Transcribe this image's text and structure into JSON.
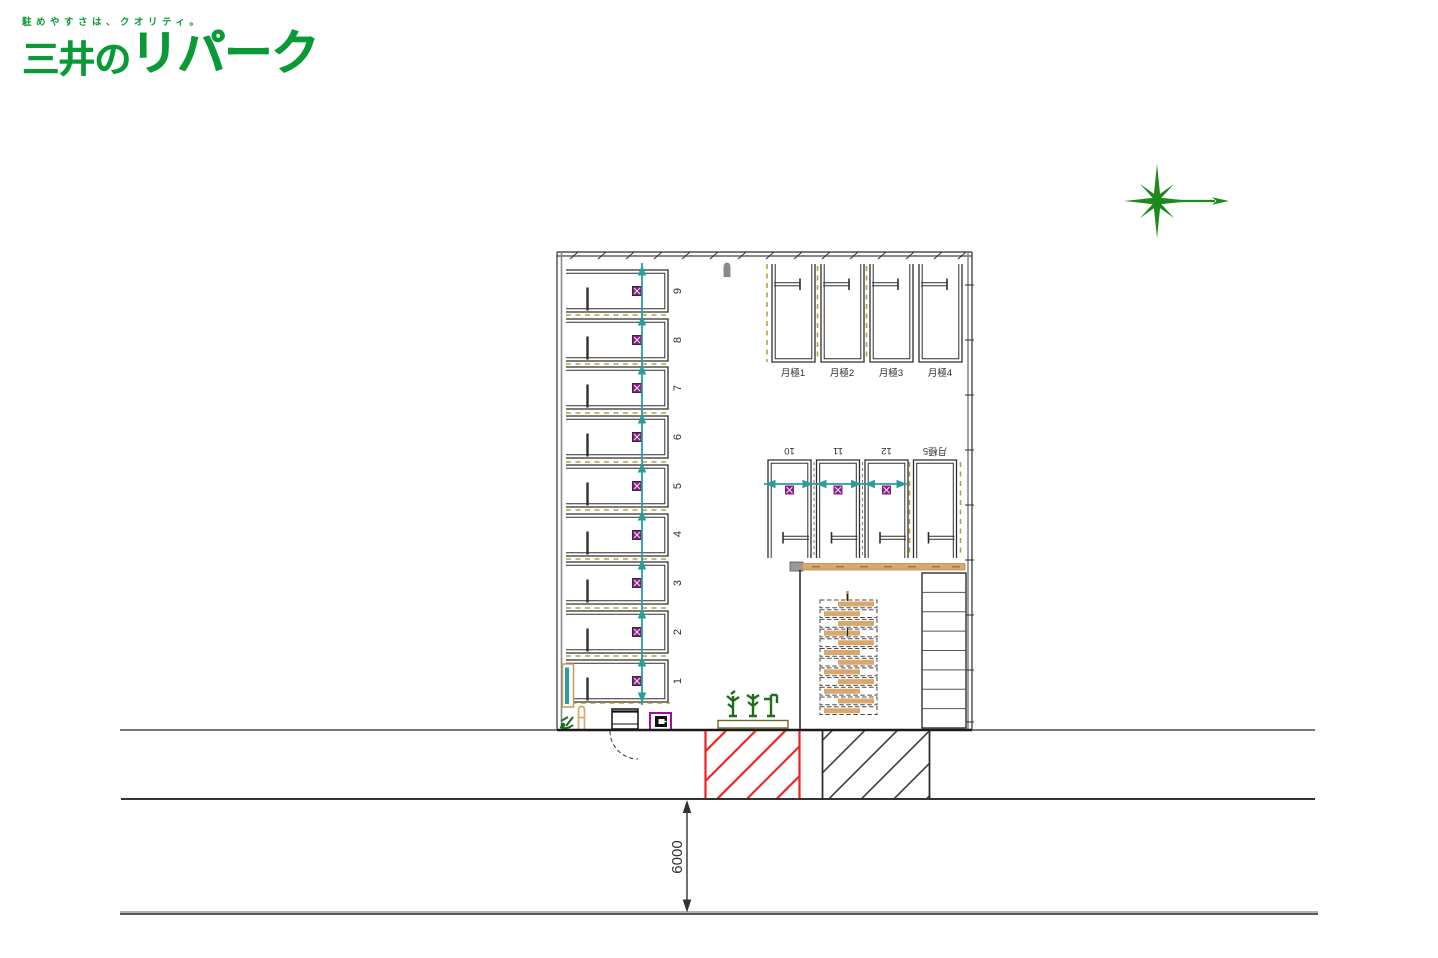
{
  "logo": {
    "tagline": "駐めやすさは、クオリティ。",
    "brand_prefix": "三井の",
    "brand_main": "リパーク",
    "brand_color": "#0a9a35"
  },
  "compass": {
    "icon": "north-compass-star",
    "color": "#1e8a1e"
  },
  "plan": {
    "stall_numbers_left": [
      "9",
      "8",
      "7",
      "6",
      "5",
      "4",
      "3",
      "2",
      "1"
    ],
    "stalls_top_monthly": [
      "月極1",
      "月極2",
      "月極3",
      "月極4"
    ],
    "stalls_middle": [
      "10",
      "11",
      "12",
      "月極5"
    ],
    "road_width_dimension": "6000",
    "colors": {
      "outline": "#2e2e2e",
      "guideline_teal": "#2a9d9d",
      "flap_lock_magenta": "#8b1a8b",
      "stall_divider_yellow": "#b5a23c",
      "wall_tan": "#d9a86c",
      "driveway_hatch_red": "#ef2020",
      "driveway_hatch_black": "#2e2e2e",
      "planting_green": "#1c6e1c"
    }
  }
}
